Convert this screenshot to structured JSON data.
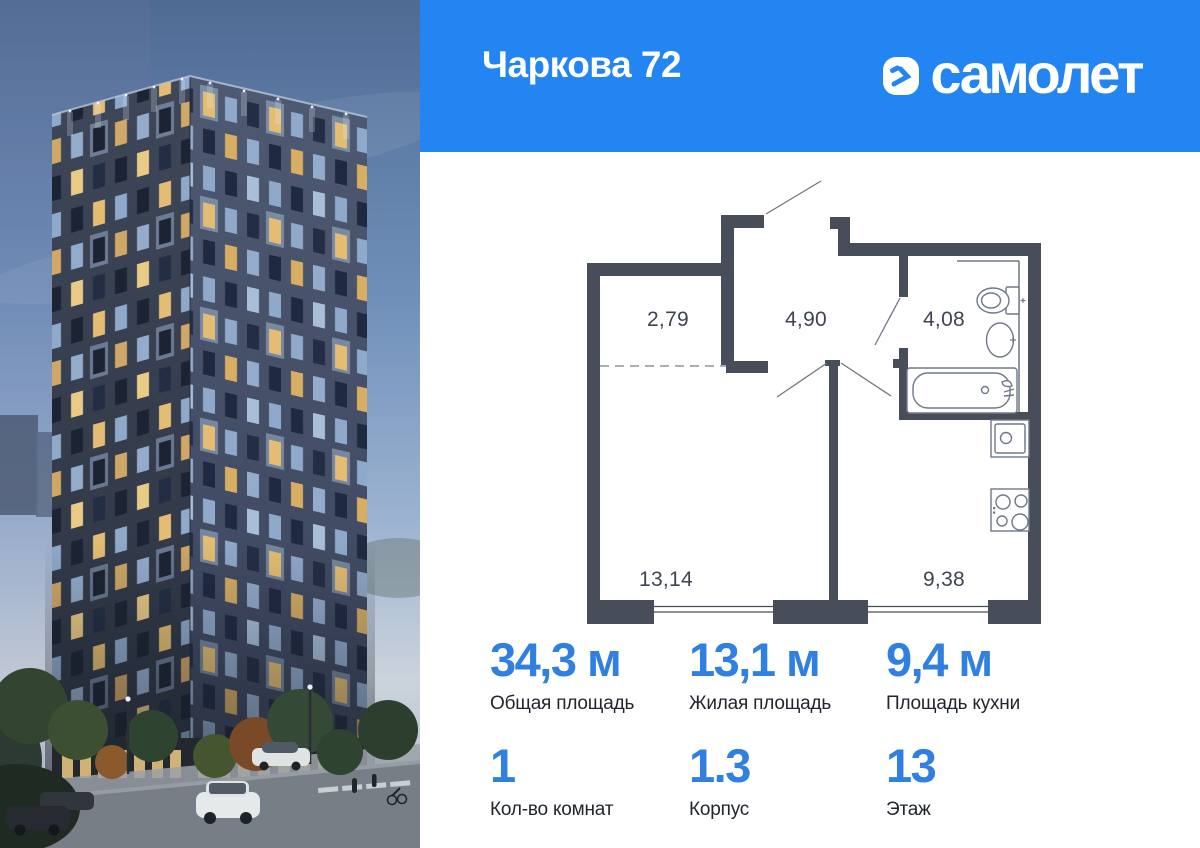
{
  "header": {
    "title": "Чаркова 72",
    "bg_color": "#2285F2",
    "brand": {
      "logo_text": "самолет",
      "logo_icon": "samolet-chevron-icon"
    }
  },
  "floorplan": {
    "wall_color": "#474E5A",
    "rooms": [
      {
        "name": "hallway",
        "area": "2,79"
      },
      {
        "name": "hall",
        "area": "4,90"
      },
      {
        "name": "bathroom",
        "area": "4,08"
      },
      {
        "name": "living-room",
        "area": "13,14"
      },
      {
        "name": "kitchen",
        "area": "9,38"
      }
    ],
    "fixtures": [
      "toilet-icon",
      "sink-icon",
      "bathtub-icon",
      "kitchen-sink-icon",
      "stove-icon"
    ]
  },
  "stats": {
    "accent_color": "#2F80E0",
    "rows": [
      [
        {
          "value": "34,3 м",
          "label": "Общая площадь"
        },
        {
          "value": "13,1 м",
          "label": "Жилая площадь"
        },
        {
          "value": "9,4 м",
          "label": "Площадь кухни"
        }
      ],
      [
        {
          "value": "1",
          "label": "Кол-во комнат"
        },
        {
          "value": "1.3",
          "label": "Корпус"
        },
        {
          "value": "13",
          "label": "Этаж"
        }
      ]
    ]
  }
}
